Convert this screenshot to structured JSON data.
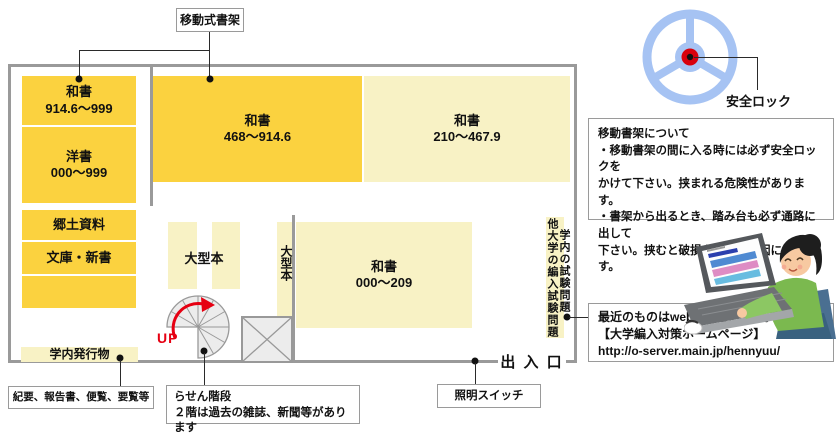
{
  "colors": {
    "shelf_dark_yellow": "#fbd23f",
    "shelf_pale_yellow": "#f8f2c5",
    "wall_gray": "#9a9a9a",
    "accent_red": "#e60012",
    "wheel_blue": "#a6c3f3",
    "lock_red": "#d8000c"
  },
  "map": {
    "movable_shelf_label": "移動式書架",
    "entrance_label": "出 入 口",
    "up_label": "UP",
    "blocks": {
      "w914": {
        "title": "和書",
        "range": "914.6～999"
      },
      "yosho": {
        "title": "洋書",
        "range": "000～999"
      },
      "kyodo": {
        "title": "郷土資料"
      },
      "bunko": {
        "title": "文庫・新書"
      },
      "pub": {
        "title": "学内発行物"
      },
      "w468": {
        "title": "和書",
        "range": "468～914.6"
      },
      "w210": {
        "title": "和書",
        "range": "210～467.9"
      },
      "w000": {
        "title": "和書",
        "range": "000～209"
      },
      "ogata": "大型本",
      "ogata_v": "大型本",
      "exam_right": "学内の試験問題",
      "exam_left": "他大学の編入試験問題"
    }
  },
  "annotations": {
    "kiyou": "紀要、報告書、便覧、要覧等",
    "spiral": "らせん階段\n２階は過去の雑誌、新聞等があります",
    "light_switch": "照明スイッチ",
    "safety_lock": "安全ロック",
    "shelf_info": "移動書架について\n・移動書架の間に入る時には必ず安全ロックを\nかけて下さい。挟まれる危険性があります。\n・書架から出るとき、踏み台も必ず通路に出して\n下さい。挟むと破損や故障の原因になります。",
    "web_info": "最近のものはwebで見られます。\n【大学編入対策ホームページ】\nhttp://o-server.main.jp/hennyuu/"
  }
}
